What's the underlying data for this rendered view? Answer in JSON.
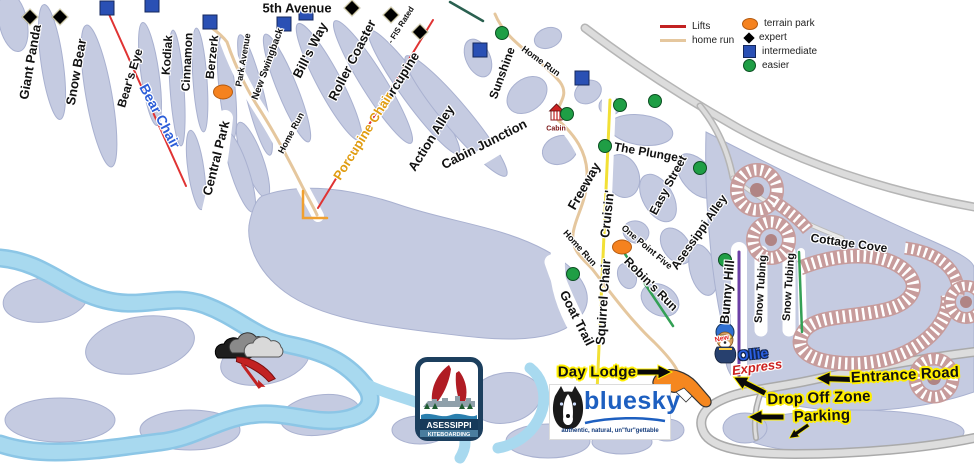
{
  "map": {
    "name": "Asessippi ski area trail map"
  },
  "legend": {
    "items": [
      {
        "id": "lifts",
        "label": "Lifts",
        "swatch": "line-red",
        "col": 0
      },
      {
        "id": "home-run",
        "label": "home run",
        "swatch": "line-tan",
        "col": 0
      },
      {
        "id": "terrain-park",
        "label": "terrain park",
        "swatch": "oval-orange",
        "col": 1
      },
      {
        "id": "expert",
        "label": "expert",
        "swatch": "diamond-black",
        "col": 1
      },
      {
        "id": "intermediate",
        "label": "intermediate",
        "swatch": "square-blue",
        "col": 1
      },
      {
        "id": "easier",
        "label": "easier",
        "swatch": "circle-green",
        "col": 1
      }
    ]
  },
  "map_labels": [
    {
      "id": "giant-panda",
      "text": "Giant Panda",
      "x": 30,
      "y": 62,
      "rot": -80,
      "size": 13,
      "cls": "trail"
    },
    {
      "id": "snow-bear",
      "text": "Snow Bear",
      "x": 76,
      "y": 72,
      "rot": -80,
      "size": 13,
      "cls": "trail"
    },
    {
      "id": "bears-eye",
      "text": "Bear's Eye",
      "x": 130,
      "y": 78,
      "rot": -73,
      "size": 12,
      "cls": "trail"
    },
    {
      "id": "kodiak",
      "text": "Kodiak",
      "x": 167,
      "y": 55,
      "rot": -86,
      "size": 12,
      "cls": "trail"
    },
    {
      "id": "cinnamon",
      "text": "Cinnamon",
      "x": 187,
      "y": 62,
      "rot": -87,
      "size": 12,
      "cls": "trail"
    },
    {
      "id": "berzerk",
      "text": "Berzerk",
      "x": 212,
      "y": 57,
      "rot": -84,
      "size": 12,
      "cls": "trail"
    },
    {
      "id": "park-avenue",
      "text": "Park Avenue",
      "x": 243,
      "y": 60,
      "rot": -80,
      "size": 9,
      "cls": "trail"
    },
    {
      "id": "new-swingback",
      "text": "New Swingback",
      "x": 268,
      "y": 64,
      "rot": -70,
      "size": 10,
      "cls": "trail"
    },
    {
      "id": "bills-way",
      "text": "Bill's Way",
      "x": 310,
      "y": 50,
      "rot": -63,
      "size": 13,
      "cls": "trail"
    },
    {
      "id": "roller-coaster",
      "text": "Roller Coaster",
      "x": 352,
      "y": 60,
      "rot": -63,
      "size": 13,
      "cls": "trail"
    },
    {
      "id": "fis-rated",
      "text": "- FIS Rated",
      "x": 401,
      "y": 25,
      "rot": -58,
      "size": 8,
      "cls": "trail"
    },
    {
      "id": "porcupine",
      "text": "Porcupine",
      "x": 399,
      "y": 80,
      "rot": -58,
      "size": 13,
      "cls": "trail"
    },
    {
      "id": "fifth-avenue",
      "text": "5th Avenue",
      "x": 297,
      "y": 8,
      "rot": 0,
      "size": 13,
      "cls": "trail"
    },
    {
      "id": "central-park",
      "text": "Central Park",
      "x": 216,
      "y": 158,
      "rot": -76,
      "size": 13,
      "cls": "trail"
    },
    {
      "id": "home-run-1",
      "text": "Home Run",
      "x": 291,
      "y": 133,
      "rot": -62,
      "size": 9,
      "cls": "trail"
    },
    {
      "id": "action-alley",
      "text": "Action Alley",
      "x": 431,
      "y": 138,
      "rot": -58,
      "size": 13,
      "cls": "trail"
    },
    {
      "id": "cabin-junction",
      "text": "Cabin Junction",
      "x": 484,
      "y": 144,
      "rot": -27,
      "size": 13,
      "cls": "trail"
    },
    {
      "id": "sunshine",
      "text": "Sunshine",
      "x": 502,
      "y": 73,
      "rot": -70,
      "size": 12,
      "cls": "trail"
    },
    {
      "id": "home-run-2",
      "text": "Home Run",
      "x": 541,
      "y": 61,
      "rot": 36,
      "size": 9,
      "cls": "trail"
    },
    {
      "id": "freeway",
      "text": "Freeway",
      "x": 584,
      "y": 186,
      "rot": -60,
      "size": 13,
      "cls": "trail"
    },
    {
      "id": "cruisin",
      "text": "Cruisin'",
      "x": 607,
      "y": 214,
      "rot": -84,
      "size": 13,
      "cls": "trail"
    },
    {
      "id": "the-plunge",
      "text": "The Plunge",
      "x": 646,
      "y": 152,
      "rot": 10,
      "size": 12,
      "cls": "trail"
    },
    {
      "id": "easy-street",
      "text": "Easy Street",
      "x": 668,
      "y": 185,
      "rot": -62,
      "size": 12,
      "cls": "trail"
    },
    {
      "id": "one-point-five",
      "text": "One Point Five",
      "x": 647,
      "y": 247,
      "rot": 40,
      "size": 9,
      "cls": "trail"
    },
    {
      "id": "asessippi-alley",
      "text": "Asessippi Alley",
      "x": 699,
      "y": 232,
      "rot": -55,
      "size": 12,
      "cls": "trail"
    },
    {
      "id": "robins-run",
      "text": "Robin's Run",
      "x": 651,
      "y": 284,
      "rot": 45,
      "size": 12,
      "cls": "trail"
    },
    {
      "id": "home-run-3",
      "text": "Home Run",
      "x": 580,
      "y": 248,
      "rot": 48,
      "size": 9,
      "cls": "trail"
    },
    {
      "id": "goat-trail",
      "text": "Goat Trail",
      "x": 577,
      "y": 318,
      "rot": 63,
      "size": 13,
      "cls": "trail"
    },
    {
      "id": "squirrel-chair",
      "text": "Squirrel Chair",
      "x": 603,
      "y": 302,
      "rot": -86,
      "size": 13,
      "cls": "trail"
    },
    {
      "id": "bunny-hill",
      "text": "Bunny Hill",
      "x": 727,
      "y": 292,
      "rot": -85,
      "size": 13,
      "cls": "trail"
    },
    {
      "id": "snow-tubing-1",
      "text": "Snow Tubing",
      "x": 761,
      "y": 289,
      "rot": -86,
      "size": 11,
      "cls": "trail"
    },
    {
      "id": "snow-tubing-2",
      "text": "Snow Tubing",
      "x": 789,
      "y": 287,
      "rot": -86,
      "size": 11,
      "cls": "trail"
    },
    {
      "id": "cottage-cove",
      "text": "Cottage Cove",
      "x": 849,
      "y": 243,
      "rot": 8,
      "size": 12,
      "cls": "trail"
    },
    {
      "id": "bear-chair",
      "text": "Bear Chair",
      "x": 160,
      "y": 116,
      "rot": 62,
      "size": 14,
      "cls": "lift-blue"
    },
    {
      "id": "porcupine-chair",
      "text": "Porcupine Chair",
      "x": 363,
      "y": 136,
      "rot": -58,
      "size": 13,
      "cls": "lift-orange"
    },
    {
      "id": "day-lodge",
      "text": "Day Lodge",
      "x": 597,
      "y": 372,
      "rot": 0,
      "size": 15,
      "cls": "poi"
    },
    {
      "id": "entrance-road",
      "text": "Entrance Road",
      "x": 905,
      "y": 375,
      "rot": -3,
      "size": 15,
      "cls": "poi"
    },
    {
      "id": "drop-off-zone",
      "text": "Drop Off Zone",
      "x": 819,
      "y": 398,
      "rot": -2,
      "size": 15,
      "cls": "poi"
    },
    {
      "id": "parking",
      "text": "Parking",
      "x": 822,
      "y": 416,
      "rot": -2,
      "size": 15,
      "cls": "poi"
    },
    {
      "id": "cabin",
      "text": "Cabin",
      "x": 556,
      "y": 129,
      "rot": 0,
      "size": 7,
      "cls": "cabin"
    },
    {
      "id": "new-tag",
      "text": "New",
      "x": 722,
      "y": 339,
      "rot": -12,
      "size": 7,
      "cls": "new"
    },
    {
      "id": "ollie",
      "text": "Ollie",
      "x": 753,
      "y": 354,
      "rot": -6,
      "size": 14,
      "cls": "ollie"
    },
    {
      "id": "express",
      "text": "Express",
      "x": 757,
      "y": 367,
      "rot": -8,
      "size": 13,
      "cls": "express"
    }
  ],
  "markers": {
    "expert": [
      [
        30,
        17
      ],
      [
        60,
        17
      ],
      [
        352,
        8
      ],
      [
        391,
        15
      ],
      [
        420,
        32
      ]
    ],
    "intermediate": [
      [
        107,
        8
      ],
      [
        152,
        5
      ],
      [
        210,
        22
      ],
      [
        284,
        24
      ],
      [
        306,
        13
      ],
      [
        480,
        50
      ],
      [
        582,
        78
      ]
    ],
    "easier": [
      [
        502,
        33
      ],
      [
        567,
        114
      ],
      [
        620,
        105
      ],
      [
        655,
        101
      ],
      [
        605,
        146
      ],
      [
        700,
        168
      ],
      [
        573,
        274
      ],
      [
        725,
        260
      ]
    ],
    "terrain_park": [
      [
        223,
        92
      ],
      [
        622,
        247
      ]
    ]
  },
  "logos": {
    "bluesky": {
      "name": "bluesky",
      "tagline": "authentic, natural, un\"fur\"gettable"
    },
    "kiteboarding": {
      "line1": "ASESSIPPI",
      "line2": "KITEBOARDING"
    }
  },
  "colors": {
    "lift_line": "#e03333",
    "home_run_line": "#e5c79e",
    "terrain_park": "#f5821f",
    "intermediate": "#2a50b4",
    "easier": "#1f9e45",
    "expert": "#000000",
    "forest": "#c5cbe1",
    "river": "#a8d9ef",
    "cottage_road": "#c79c9c",
    "squirrel_lift": "#f2e035",
    "bunny_lift": "#6b3fa6"
  }
}
